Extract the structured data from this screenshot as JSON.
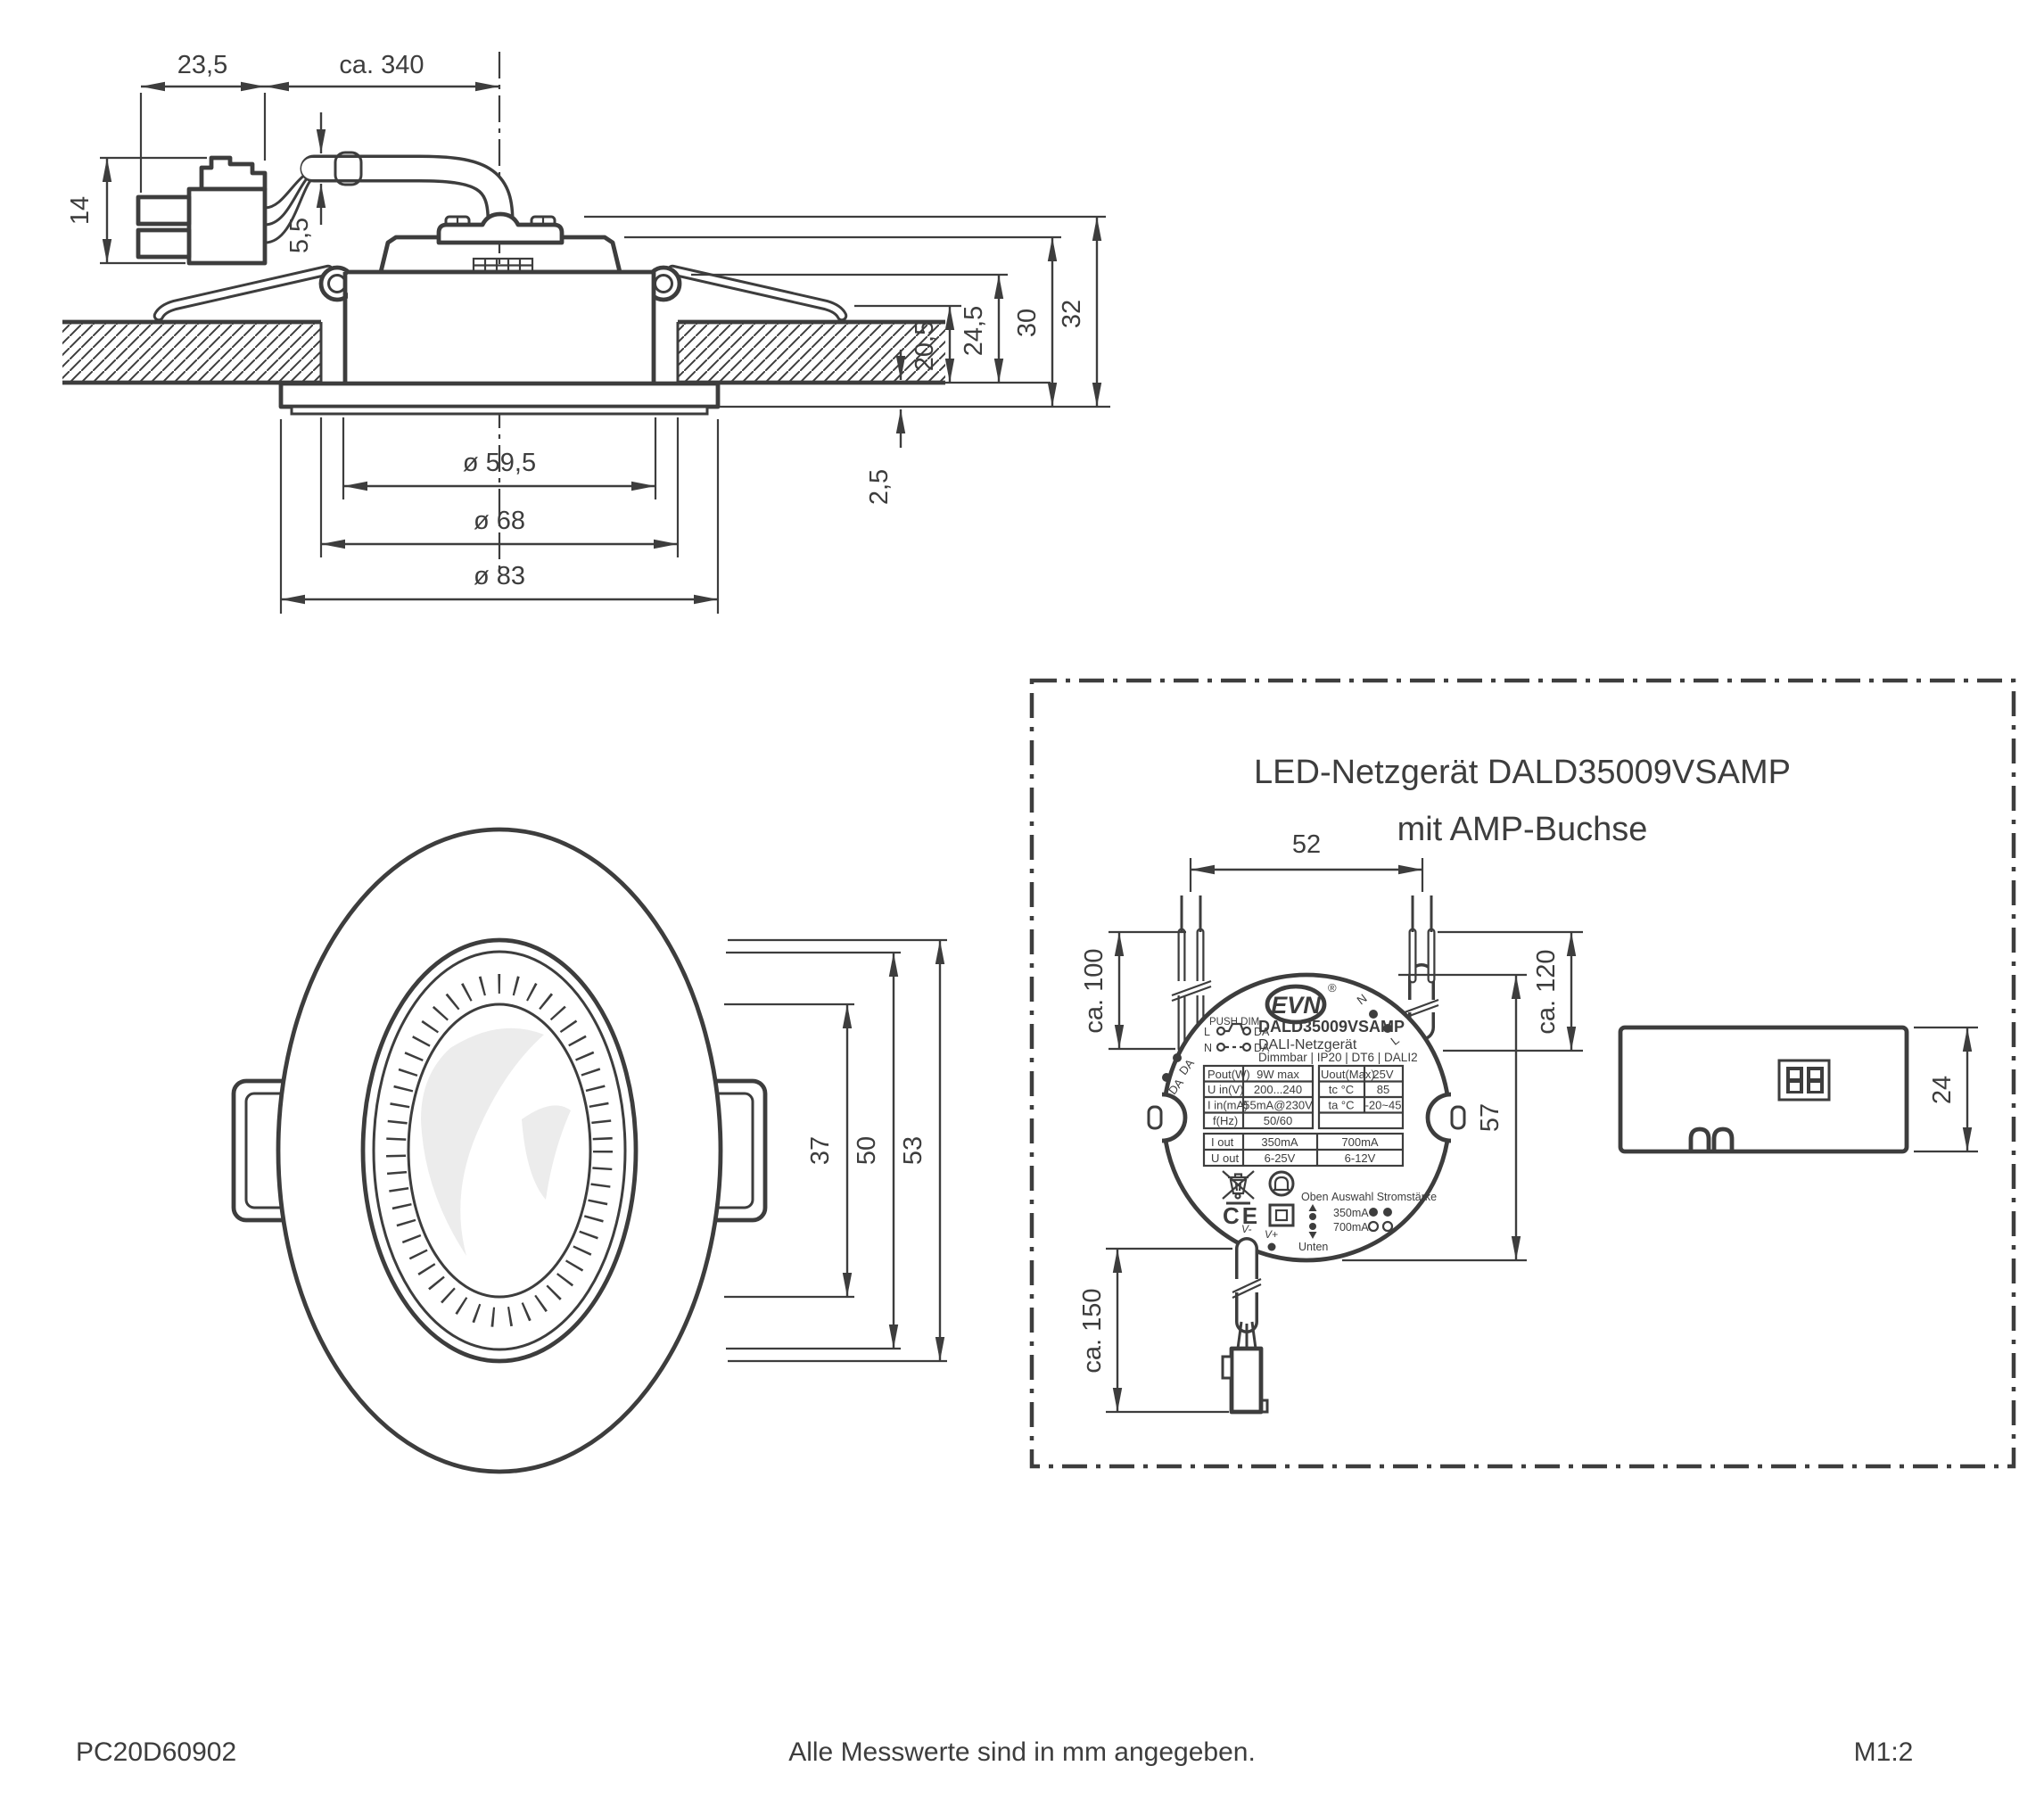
{
  "colors": {
    "line": "#3d3d3d",
    "background": "#ffffff",
    "highlight": "#ececec"
  },
  "cross_section": {
    "dims": {
      "d235": "23,5",
      "d340": "ca. 340",
      "d14": "14",
      "d55": "5,5",
      "d205": "20,5",
      "d245": "24,5",
      "d30": "30",
      "d32": "32",
      "d25": "2,5",
      "dia595": "ø 59,5",
      "dia68": "ø 68",
      "dia83": "ø 83"
    }
  },
  "front_view": {
    "dims": {
      "d37": "37",
      "d50": "50",
      "d53": "53"
    }
  },
  "driver_box": {
    "title1": "LED-Netzgerät DALD35009VSAMP",
    "title2": "mit AMP-Buchse",
    "dims": {
      "d52": "52",
      "d100": "ca. 100",
      "d120": "ca. 120",
      "d57": "57",
      "d150": "ca. 150",
      "d24": "24"
    },
    "label": {
      "brand": "EVN",
      "reg": "®",
      "model": "DALD35009VSAMP",
      "type": "DALI-Netzgerät",
      "features": "Dimmbar | IP20 | DT6 | DALI2",
      "push_dim": "PUSH DIM",
      "pd_l": "L",
      "pd_n": "N",
      "pd_da1": "DA",
      "pd_da2": "DA",
      "terminals": {
        "da1": "DA",
        "da2": "DA",
        "n": "N",
        "l": "L",
        "vminus": "V-",
        "vplus": "V+"
      },
      "table": {
        "p_l": "Pout(W)",
        "p_v": "9W max",
        "uo_l": "Uout(Max)",
        "uo_v": "25V",
        "ui_l": "U in(V)",
        "ui_v": "200...240",
        "tc_l": "tc °C",
        "tc_v": "85",
        "ii_l": "I in(mA)",
        "ii_v": "55mA@230V",
        "ta_l": "ta °C",
        "ta_v": "-20~45",
        "f_l": "f(Hz)",
        "f_v": "50/60",
        "io_l": "I out",
        "io_1": "350mA",
        "io_2": "700mA",
        "uout_l": "U out",
        "uout_1": "6-25V",
        "uout_2": "6-12V"
      },
      "ce": "CE",
      "orientation": {
        "oben": "Oben",
        "unten": "Unten"
      },
      "current_select": {
        "heading": "Auswahl Stromstärke",
        "opt1": "350mA",
        "opt2": "700mA"
      }
    }
  },
  "footer": {
    "doc_number": "PC20D60902",
    "note": "Alle Messwerte sind in mm angegeben.",
    "scale": "M1:2"
  }
}
